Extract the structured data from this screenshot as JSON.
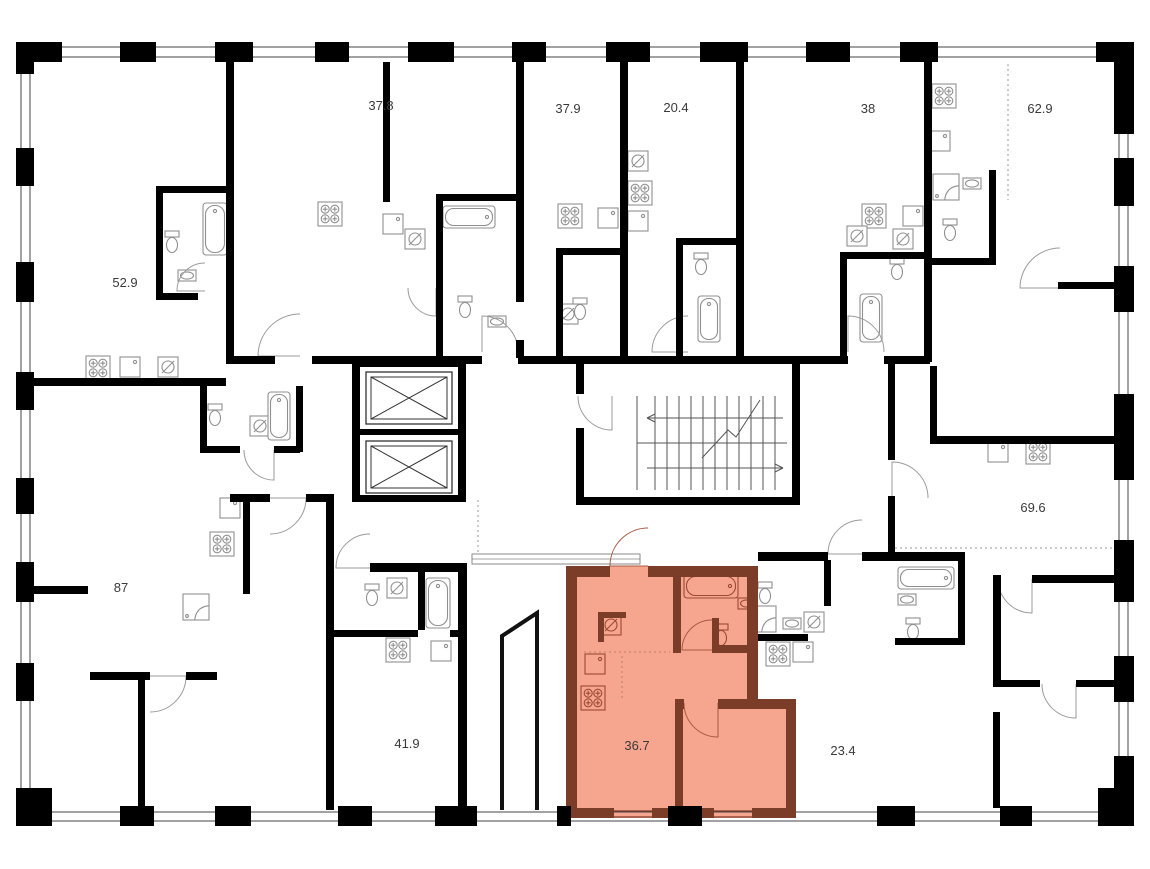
{
  "plan": {
    "colors": {
      "background": "#ffffff",
      "wall": "#000000",
      "highlight_fill": "#f6a58f",
      "highlight_wall": "#7b3c28",
      "fixture": "#8f8f8f",
      "highlight_fixture": "#9c4a33",
      "label": "#3a3a3a",
      "thin_line": "#444444"
    },
    "units": [
      {
        "label": "52.9",
        "x": 125,
        "y": 287,
        "highlighted": false
      },
      {
        "label": "37.8",
        "x": 381,
        "y": 110,
        "highlighted": false
      },
      {
        "label": "37.9",
        "x": 568,
        "y": 113,
        "highlighted": false
      },
      {
        "label": "20.4",
        "x": 676,
        "y": 112,
        "highlighted": false
      },
      {
        "label": "38",
        "x": 868,
        "y": 113,
        "highlighted": false
      },
      {
        "label": "62.9",
        "x": 1040,
        "y": 113,
        "highlighted": false
      },
      {
        "label": "87",
        "x": 121,
        "y": 592,
        "highlighted": false
      },
      {
        "label": "41.9",
        "x": 407,
        "y": 748,
        "highlighted": false
      },
      {
        "label": "36.7",
        "x": 637,
        "y": 750,
        "highlighted": true
      },
      {
        "label": "23.4",
        "x": 843,
        "y": 755,
        "highlighted": false
      },
      {
        "label": "69.6",
        "x": 1033,
        "y": 512,
        "highlighted": false
      }
    ],
    "highlight_polygon": "566,566 758,566 758,699 796,699 796,818 566,818",
    "ramp_polyline": "502,810 502,636 537,613 537,810",
    "fixtures": [
      {
        "t": "stove",
        "x": 86,
        "y": 356
      },
      {
        "t": "stove",
        "x": 318,
        "y": 202
      },
      {
        "t": "stove",
        "x": 558,
        "y": 204
      },
      {
        "t": "stove",
        "x": 628,
        "y": 181
      },
      {
        "t": "stove",
        "x": 862,
        "y": 204
      },
      {
        "t": "stove",
        "x": 932,
        "y": 84
      },
      {
        "t": "stove",
        "x": 210,
        "y": 532
      },
      {
        "t": "stove",
        "x": 386,
        "y": 638
      },
      {
        "t": "stove",
        "x": 581,
        "y": 686,
        "hl": true
      },
      {
        "t": "stove",
        "x": 766,
        "y": 642
      },
      {
        "t": "stove",
        "x": 1026,
        "y": 440
      },
      {
        "t": "sink",
        "x": 120,
        "y": 357
      },
      {
        "t": "sink",
        "x": 383,
        "y": 214
      },
      {
        "t": "sink",
        "x": 598,
        "y": 208
      },
      {
        "t": "sink",
        "x": 628,
        "y": 211
      },
      {
        "t": "sink",
        "x": 903,
        "y": 206
      },
      {
        "t": "sink",
        "x": 930,
        "y": 131
      },
      {
        "t": "sink",
        "x": 220,
        "y": 498
      },
      {
        "t": "sink",
        "x": 431,
        "y": 641
      },
      {
        "t": "sink",
        "x": 585,
        "y": 654,
        "hl": true
      },
      {
        "t": "sink",
        "x": 793,
        "y": 642
      },
      {
        "t": "sink",
        "x": 988,
        "y": 442
      },
      {
        "t": "washer",
        "x": 158,
        "y": 357
      },
      {
        "t": "washer",
        "x": 405,
        "y": 229
      },
      {
        "t": "washer",
        "x": 558,
        "y": 304
      },
      {
        "t": "washer",
        "x": 628,
        "y": 151
      },
      {
        "t": "washer",
        "x": 847,
        "y": 226
      },
      {
        "t": "washer",
        "x": 893,
        "y": 229
      },
      {
        "t": "washer",
        "x": 250,
        "y": 416
      },
      {
        "t": "washer",
        "x": 387,
        "y": 578
      },
      {
        "t": "washer",
        "x": 601,
        "y": 615,
        "hl": true
      },
      {
        "t": "washer",
        "x": 804,
        "y": 612
      },
      {
        "t": "tub",
        "x": 203,
        "y": 203,
        "w": 24,
        "h": 52
      },
      {
        "t": "tub",
        "x": 443,
        "y": 206,
        "w": 52,
        "h": 22
      },
      {
        "t": "tub",
        "x": 698,
        "y": 296,
        "w": 22,
        "h": 46
      },
      {
        "t": "tub",
        "x": 860,
        "y": 294,
        "w": 22,
        "h": 48
      },
      {
        "t": "tub",
        "x": 268,
        "y": 392,
        "w": 22,
        "h": 48
      },
      {
        "t": "tub",
        "x": 426,
        "y": 578,
        "w": 24,
        "h": 50
      },
      {
        "t": "tub",
        "x": 684,
        "y": 574,
        "w": 54,
        "h": 24,
        "hl": true
      },
      {
        "t": "tub",
        "x": 898,
        "y": 567,
        "w": 56,
        "h": 22
      },
      {
        "t": "toilet",
        "x": 165,
        "y": 231
      },
      {
        "t": "toilet",
        "x": 458,
        "y": 296
      },
      {
        "t": "toilet",
        "x": 573,
        "y": 298
      },
      {
        "t": "toilet",
        "x": 694,
        "y": 253
      },
      {
        "t": "toilet",
        "x": 890,
        "y": 258
      },
      {
        "t": "toilet",
        "x": 943,
        "y": 219
      },
      {
        "t": "toilet",
        "x": 208,
        "y": 404
      },
      {
        "t": "toilet",
        "x": 365,
        "y": 584
      },
      {
        "t": "toilet",
        "x": 714,
        "y": 624,
        "hl": true
      },
      {
        "t": "toilet",
        "x": 758,
        "y": 582
      },
      {
        "t": "toilet",
        "x": 906,
        "y": 618
      },
      {
        "t": "shower",
        "x": 933,
        "y": 174
      },
      {
        "t": "shower",
        "x": 183,
        "y": 594
      },
      {
        "t": "shower",
        "x": 750,
        "y": 606
      },
      {
        "t": "basin",
        "x": 178,
        "y": 270
      },
      {
        "t": "basin",
        "x": 488,
        "y": 316
      },
      {
        "t": "basin",
        "x": 963,
        "y": 178
      },
      {
        "t": "basin",
        "x": 898,
        "y": 594
      },
      {
        "t": "basin",
        "x": 783,
        "y": 618
      },
      {
        "t": "basin",
        "x": 738,
        "y": 598,
        "hl": true
      }
    ],
    "doors": [
      [
        300,
        356,
        42,
        180,
        270,
        0
      ],
      [
        482,
        352,
        36,
        270,
        360,
        0
      ],
      [
        688,
        352,
        36,
        180,
        270,
        0
      ],
      [
        848,
        352,
        36,
        270,
        360,
        0
      ],
      [
        270,
        498,
        36,
        0,
        90,
        0
      ],
      [
        370,
        568,
        34,
        180,
        270,
        0
      ],
      [
        648,
        566,
        38,
        180,
        270,
        1
      ],
      [
        712,
        650,
        30,
        180,
        270,
        1
      ],
      [
        718,
        703,
        34,
        90,
        180,
        1
      ],
      [
        862,
        554,
        34,
        180,
        270,
        0
      ],
      [
        892,
        498,
        36,
        270,
        360,
        0
      ],
      [
        1032,
        579,
        34,
        90,
        180,
        0
      ],
      [
        1076,
        684,
        34,
        90,
        180,
        0
      ],
      [
        612,
        396,
        34,
        90,
        180,
        0
      ],
      [
        205,
        291,
        28,
        180,
        270,
        0
      ],
      [
        274,
        450,
        30,
        90,
        180,
        0
      ],
      [
        150,
        676,
        36,
        0,
        90,
        0
      ],
      [
        436,
        288,
        28,
        90,
        180,
        0
      ],
      [
        1060,
        288,
        40,
        180,
        270,
        0
      ]
    ],
    "dotted_lines": [
      [
        622,
        656,
        622,
        698,
        1
      ],
      [
        584,
        652,
        670,
        652,
        1
      ],
      [
        895,
        548,
        1112,
        548,
        0
      ],
      [
        1008,
        64,
        1008,
        200,
        0
      ],
      [
        478,
        500,
        478,
        552,
        0
      ],
      [
        333,
        604,
        333,
        640,
        0
      ]
    ],
    "elevators": [
      [
        366,
        372,
        86,
        52
      ],
      [
        366,
        441,
        86,
        52
      ]
    ],
    "stairs": {
      "x1": 655,
      "x2": 775,
      "y1": 396,
      "y2": 490,
      "mid": 443
    }
  }
}
